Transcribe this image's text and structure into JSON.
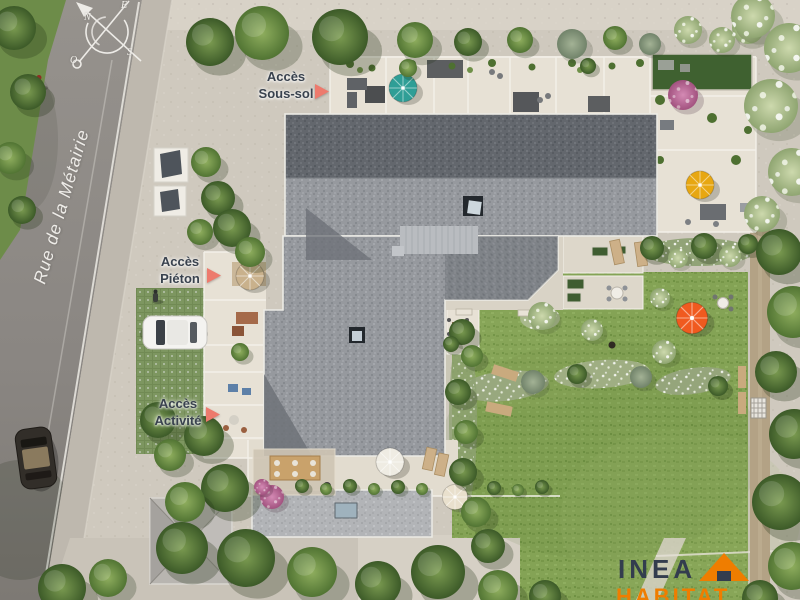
{
  "street": {
    "name": "Rue de la Métairie"
  },
  "compass": {
    "n": "N",
    "e": "E",
    "s": "S",
    "o": "O"
  },
  "access_labels": {
    "sous_sol": {
      "line1": "Accès",
      "line2": "Sous-sol"
    },
    "pieton": {
      "line1": "Accès",
      "line2": "Piéton"
    },
    "activite": {
      "line1": "Accès",
      "line2": "Activité"
    }
  },
  "logo": {
    "name": "INEA",
    "tagline": "HABITAT"
  },
  "icons": {
    "compass": "compass-rose-icon",
    "access_arrow": "arrow-right-icon",
    "logo_roof": "house-roof-icon"
  },
  "colors": {
    "access_arrow": "#ed7a6d",
    "access_text": "#39424e",
    "street_text": "#f4f2ee",
    "logo_navy": "#333d4e",
    "logo_orange": "#ef7d00",
    "umbrella_teal": "#2f9e96",
    "umbrella_yellow": "#e7a712",
    "umbrella_orange": "#f05a1f",
    "umbrella_tan": "#c9b18c",
    "umbrella_white": "#efece3",
    "umbrella_cream": "#e9e0cd"
  }
}
